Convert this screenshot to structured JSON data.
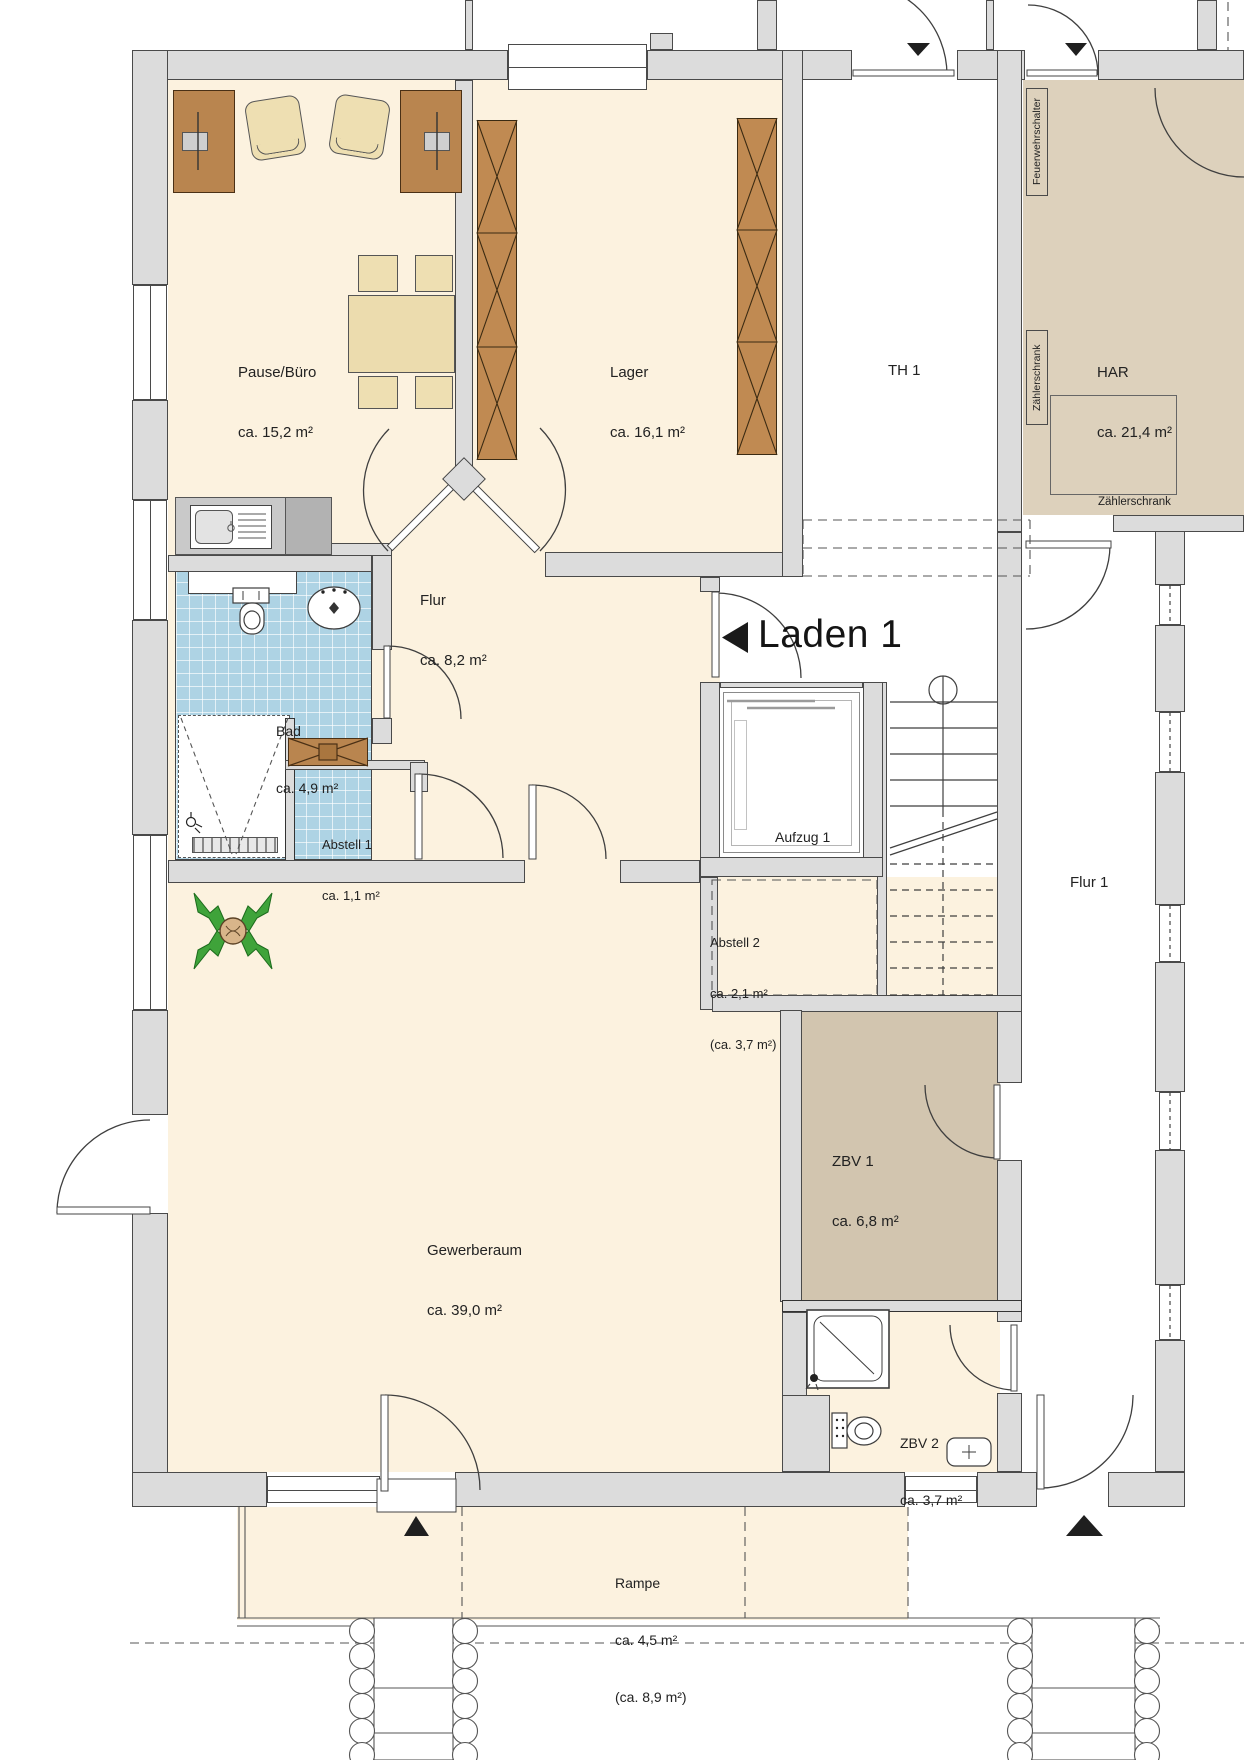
{
  "title": {
    "text": "Laden 1"
  },
  "rooms": {
    "pause_buero": {
      "name": "Pause/Büro",
      "area": "ca. 15,2 m²"
    },
    "lager": {
      "name": "Lager",
      "area": "ca. 16,1 m²"
    },
    "th1": {
      "name": "TH 1"
    },
    "har": {
      "name": "HAR",
      "area": "ca. 21,4 m²"
    },
    "flur": {
      "name": "Flur",
      "area": "ca. 8,2 m²"
    },
    "bad": {
      "name": "Bad",
      "area": "ca. 4,9 m²"
    },
    "abstell1": {
      "name": "Abstell 1",
      "area": "ca. 1,1 m²"
    },
    "aufzug1": {
      "name": "Aufzug 1"
    },
    "abstell2": {
      "name": "Abstell 2",
      "area": "ca. 2,1 m²",
      "area_alt": "(ca. 3,7 m²)"
    },
    "flur1": {
      "name": "Flur 1"
    },
    "zbv1": {
      "name": "ZBV 1",
      "area": "ca. 6,8 m²"
    },
    "gewerberaum": {
      "name": "Gewerberaum",
      "area": "ca. 39,0 m²"
    },
    "zbv2": {
      "name": "ZBV 2",
      "area": "ca. 3,7 m²"
    },
    "rampe": {
      "name": "Rampe",
      "area": "ca. 4,5 m²",
      "area_alt": "(ca. 8,9 m²)"
    }
  },
  "annotations": {
    "feuerwehrschalter": "Feuerwehrschalter",
    "zaehlerschrank_vertical": "Zählerschrank",
    "zaehlerschrank_horizontal": "Zählerschrank"
  },
  "colors": {
    "floor_cream": "#fcf2df",
    "har_tan": "#ddd1bc",
    "zbv1_tan": "#d2c5af",
    "bath_tile_blue": "#aed3e4",
    "wall_gray": "#dcdcdc",
    "furniture_brown": "#b9854f",
    "seat_beige": "#eedfb2",
    "plant_green": "#3fa33a",
    "line_dark": "#3f3f3f"
  }
}
